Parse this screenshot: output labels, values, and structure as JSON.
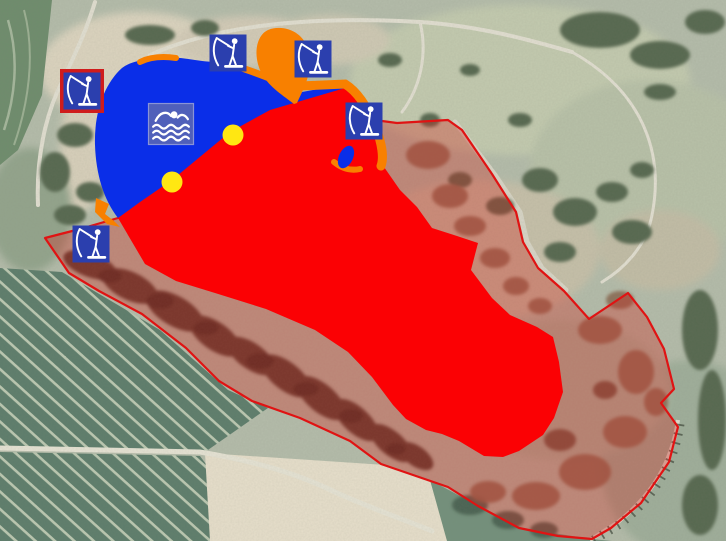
{
  "map": {
    "kind": "aerial-photo-with-zone-overlays",
    "colors": {
      "swim_zone": "#0a2ee8",
      "restricted_zone": "#fb0104",
      "shore_marking": "#f88000",
      "buoy": "#ffe712",
      "reserve_fill": "rgba(212,42,32,0.34)",
      "reserve_border": "#e01313",
      "icon_blue": "#2b3fae",
      "icon_frame": "#cf1c1c",
      "swim_icon_bg": "#5060ba",
      "swim_icon_border": "#8a94d6",
      "icon_glyph": "#ffffff"
    },
    "zones": [
      {
        "id": "swimming-zone",
        "color_key": "swim_zone"
      },
      {
        "id": "restricted-water-zone",
        "color_key": "restricted_zone"
      },
      {
        "id": "protected-area",
        "color_key": "reserve_fill"
      },
      {
        "id": "shore-markings",
        "color_key": "shore_marking"
      }
    ],
    "markers": {
      "fishing_spots": [
        {
          "x": 82,
          "y": 91,
          "size": 37,
          "framed": true
        },
        {
          "x": 228,
          "y": 53,
          "size": 37,
          "framed": false
        },
        {
          "x": 313,
          "y": 59,
          "size": 37,
          "framed": false
        },
        {
          "x": 364,
          "y": 121,
          "size": 37,
          "framed": false
        },
        {
          "x": 91,
          "y": 244,
          "size": 37,
          "framed": false
        }
      ],
      "swimming_area_sign": {
        "x": 171,
        "y": 124,
        "w": 45,
        "h": 41
      },
      "buoys": [
        {
          "x": 233,
          "y": 135,
          "r": 10.5
        },
        {
          "x": 172,
          "y": 182,
          "r": 10.5
        }
      ]
    }
  }
}
